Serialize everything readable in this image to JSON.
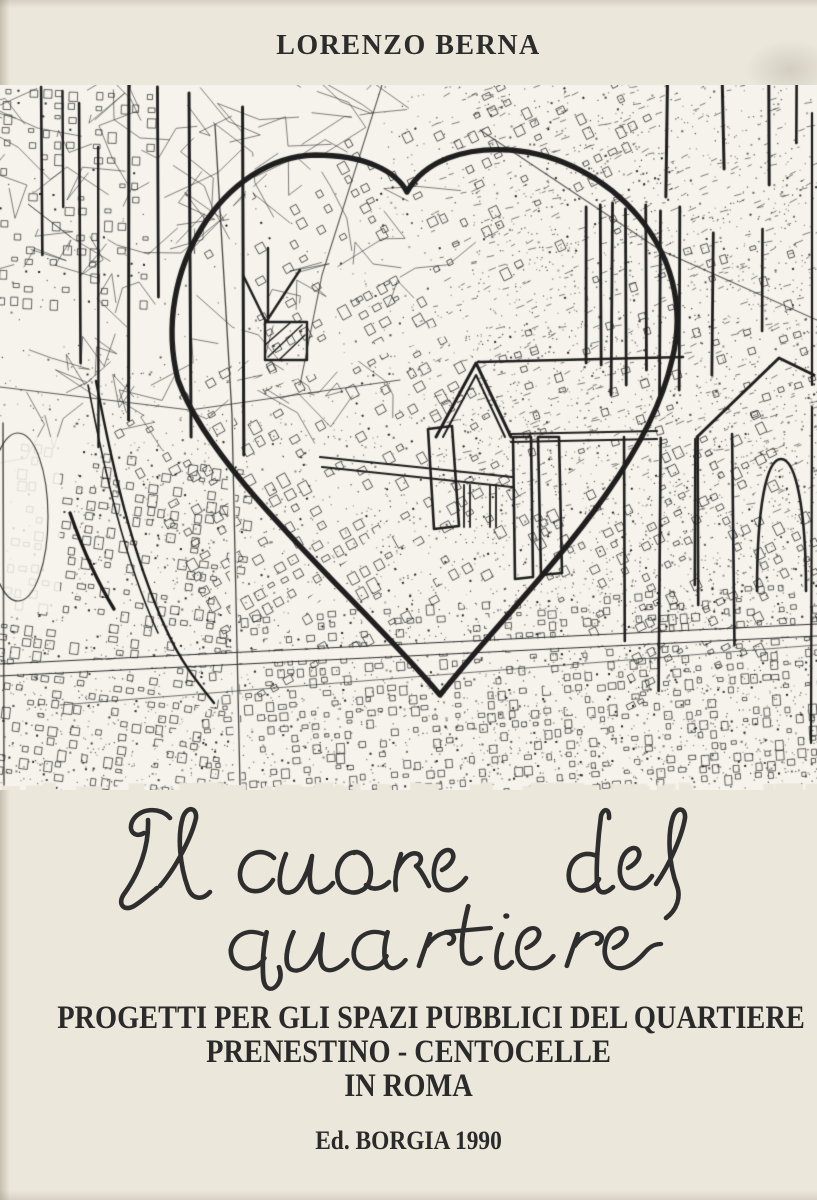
{
  "page": {
    "author": "LORENZO BERNA",
    "handwritten_title": {
      "line1": "Il cuore del",
      "line2": "quartiere",
      "full": "Il cuore del quartiere"
    },
    "subtitle": {
      "line1": "PROGETTI PER GLI SPAZI PUBBLICI DEL QUARTIERE",
      "line2": "PRENESTINO - CENTOCELLE",
      "line3": "IN ROMA"
    },
    "publisher": "Ed. BORGIA 1990",
    "artwork": {
      "description": "Photocopied black-and-white aerial map of the Prenestino-Centocelle district of Rome with a large hand-drawn heart outline, vertical posts, a gabled temple front with columns, a second gable and an arch sketched in heavy ink over the map",
      "ink_color": "#1f1f1f",
      "paper_color": "#f6f3ec"
    }
  }
}
